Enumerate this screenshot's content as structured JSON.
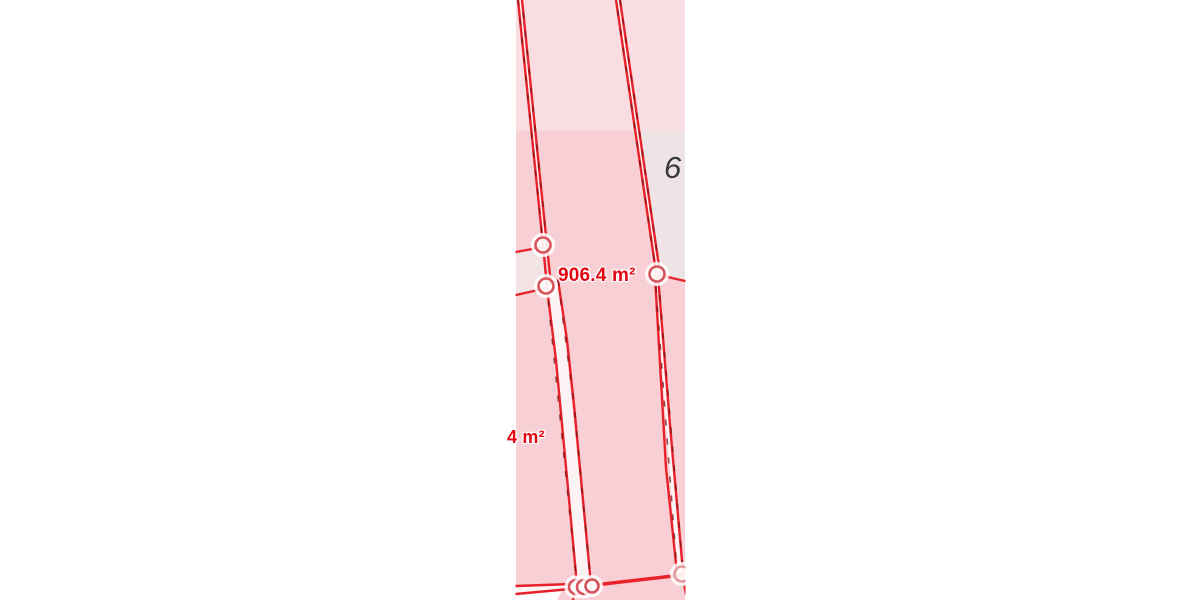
{
  "map": {
    "description": "cadastral parcel map with area measurement overlay",
    "labels": {
      "area_main": "906.4 m²",
      "area_partial": "4 m²",
      "parcel_number": "6"
    },
    "colors": {
      "background": "#ffffff",
      "boundary_red": "#e8222a",
      "dash_dark": "#7d1115",
      "parcel_pink": "#f8cfd4",
      "parcel_pink_light": "#fbdee3",
      "neighbor_gray": "#eee3e5",
      "wedge_light": "#f3e3e5",
      "label_red": "#e30613",
      "number_gray": "#3a3a3a",
      "vertex_ring": "#d6545c"
    },
    "vertices": [
      {
        "x": 543,
        "y": 245,
        "r": 7.5
      },
      {
        "x": 546,
        "y": 286,
        "r": 7.5
      },
      {
        "x": 657,
        "y": 274,
        "r": 7.5
      },
      {
        "x": 576,
        "y": 587,
        "r": 7
      },
      {
        "x": 584,
        "y": 587,
        "r": 7
      },
      {
        "x": 592,
        "y": 586,
        "r": 6.5
      },
      {
        "x": 682,
        "y": 574,
        "r": 7.5,
        "pale": true
      }
    ]
  }
}
